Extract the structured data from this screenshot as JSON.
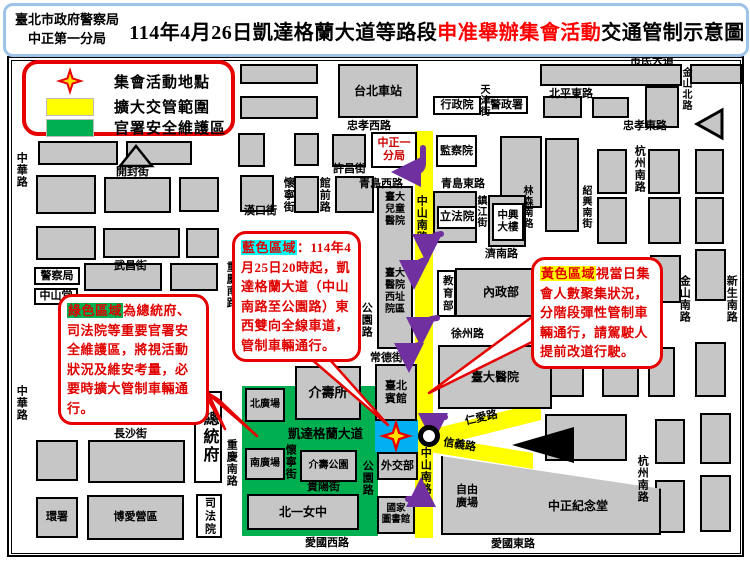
{
  "header": {
    "agency_line1": "臺北市政府警察局",
    "agency_line2": "中正第一分局",
    "title_prefix": "114年4月26日凱達格蘭大道等路段",
    "title_highlight": "申准舉辦集會活動",
    "title_suffix": "交通管制示意圖"
  },
  "legend": {
    "items": [
      {
        "symbol": "star-icon",
        "label": "集會活動地點"
      },
      {
        "symbol": "yellow-swatch",
        "label": "擴大交管範圍",
        "color": "#FFFF00"
      },
      {
        "symbol": "green-swatch",
        "label": "官署安全維護區",
        "color": "#00B050"
      }
    ]
  },
  "callouts": {
    "blue": {
      "highlight": "藍色區域",
      "text": "：114年4月25日20時起，凱達格蘭大道（中山南路至公園路）東西雙向全線車道，管制車輛通行。"
    },
    "green": {
      "highlight": "綠色區域",
      "text": "為總統府、司法院等重要官署安全維護區，將視活動狀況及維安考量，必要時擴大管制車輛通行。"
    },
    "yellow": {
      "highlight": "黃色區域",
      "text": "視當日集會人數聚集狀況，分階段彈性管制車輛通行，請駕駛人提前改道行駛。"
    }
  },
  "colors": {
    "zone_yellow": "#ffff00",
    "zone_green": "#00b050",
    "zone_blue": "#00b0f0",
    "callout_red": "#e60000",
    "purple_arrow": "#7030a0",
    "title_border_blue": "#9dc3e6",
    "block_gray": "#c6c6c6"
  },
  "map": {
    "zones": [
      {
        "id": "road-zhongshan-south-yellow",
        "x": 415,
        "y": 131,
        "w": 18,
        "h": 407,
        "color": "#ffff00"
      },
      {
        "id": "security-zone-green",
        "x": 242,
        "y": 386,
        "w": 136,
        "h": 150,
        "color": "#00b050"
      },
      {
        "id": "kaidagelan-east-blue",
        "x": 375,
        "y": 420,
        "w": 43,
        "h": 32,
        "color": "#00b0f0"
      }
    ],
    "blocks": [
      [
        36,
        64,
        64,
        20
      ],
      [
        36,
        92,
        64,
        23
      ],
      [
        240,
        64,
        78,
        20
      ],
      [
        240,
        96,
        78,
        23
      ],
      [
        540,
        64,
        142,
        22
      ],
      [
        690,
        64,
        52,
        20
      ],
      [
        543,
        96,
        39,
        22
      ],
      [
        592,
        97,
        37,
        21
      ],
      [
        645,
        86,
        34,
        42
      ],
      [
        238,
        133,
        27,
        34
      ],
      [
        294,
        133,
        25,
        33
      ],
      [
        332,
        134,
        34,
        33
      ],
      [
        38,
        141,
        80,
        24
      ],
      [
        126,
        141,
        66,
        24
      ],
      [
        36,
        175,
        60,
        39
      ],
      [
        104,
        177,
        67,
        36
      ],
      [
        179,
        177,
        40,
        35
      ],
      [
        240,
        175,
        34,
        37
      ],
      [
        294,
        176,
        25,
        37
      ],
      [
        335,
        176,
        39,
        37
      ],
      [
        36,
        226,
        60,
        34
      ],
      [
        103,
        228,
        77,
        30
      ],
      [
        186,
        228,
        33,
        30
      ],
      [
        84,
        263,
        78,
        28
      ],
      [
        170,
        263,
        48,
        28
      ],
      [
        500,
        136,
        42,
        72
      ],
      [
        545,
        138,
        34,
        94
      ],
      [
        597,
        149,
        30,
        45
      ],
      [
        597,
        197,
        30,
        47
      ],
      [
        648,
        149,
        32,
        45
      ],
      [
        648,
        197,
        33,
        47
      ],
      [
        695,
        149,
        29,
        45
      ],
      [
        695,
        197,
        29,
        47
      ],
      [
        550,
        265,
        42,
        42
      ],
      [
        600,
        259,
        43,
        44
      ],
      [
        650,
        255,
        31,
        48
      ],
      [
        695,
        249,
        31,
        52
      ],
      [
        547,
        355,
        37,
        42
      ],
      [
        602,
        352,
        37,
        45
      ],
      [
        648,
        347,
        27,
        50
      ],
      [
        695,
        342,
        31,
        55
      ],
      [
        545,
        414,
        82,
        47
      ],
      [
        655,
        419,
        30,
        45
      ],
      [
        700,
        413,
        31,
        51
      ],
      [
        655,
        480,
        30,
        53
      ],
      [
        700,
        475,
        31,
        57
      ],
      [
        36,
        440,
        42,
        41
      ],
      [
        88,
        440,
        97,
        43
      ],
      [
        433,
        191,
        44,
        52
      ],
      [
        488,
        195,
        38,
        52
      ],
      [
        377,
        186,
        36,
        163
      ],
      [
        441,
        451,
        220,
        84,
        "polygon(0 6%,100% 45%,100% 100%,0 100%)"
      ]
    ],
    "boxes": [
      {
        "t": "台北車站",
        "x": 338,
        "y": 64,
        "w": 80,
        "h": 54,
        "cls": "gb",
        "fs": 12,
        "name": "taipei-main-station"
      },
      {
        "t": "介壽所",
        "x": 295,
        "y": 366,
        "w": 66,
        "h": 54,
        "cls": "gb",
        "fs": 13,
        "name": "jieshou-police-post"
      },
      {
        "t": "北廣場",
        "x": 245,
        "y": 388,
        "w": 40,
        "h": 34,
        "cls": "gb",
        "fs": 10,
        "name": "north-plaza"
      },
      {
        "t": "南廣場",
        "x": 245,
        "y": 448,
        "w": 40,
        "h": 32,
        "cls": "gb",
        "fs": 10,
        "name": "south-plaza"
      },
      {
        "t": "介壽公園",
        "x": 300,
        "y": 450,
        "w": 57,
        "h": 32,
        "cls": "gb",
        "fs": 10,
        "name": "jieshou-park"
      },
      {
        "t": "北一女中",
        "x": 247,
        "y": 494,
        "w": 112,
        "h": 36,
        "cls": "gb",
        "fs": 12,
        "name": "taipei-first-girls-hs"
      },
      {
        "t": "臺北\n賓館",
        "x": 375,
        "y": 364,
        "w": 42,
        "h": 57,
        "cls": "gb",
        "fs": 11,
        "name": "taipei-guest-house"
      },
      {
        "t": "外交部",
        "x": 377,
        "y": 452,
        "w": 41,
        "h": 28,
        "cls": "gb",
        "fs": 11,
        "name": "ministry-foreign-affairs"
      },
      {
        "t": "國家\n圖書館",
        "x": 377,
        "y": 496,
        "w": 38,
        "h": 38,
        "cls": "gb",
        "fs": 9.5,
        "name": "national-library"
      },
      {
        "t": "內政部",
        "x": 455,
        "y": 268,
        "w": 92,
        "h": 49,
        "cls": "gb",
        "fs": 12,
        "name": "ministry-interior"
      },
      {
        "t": "臺大醫院",
        "x": 438,
        "y": 345,
        "w": 114,
        "h": 64,
        "cls": "gb",
        "fs": 12,
        "name": "ntu-hospital"
      },
      {
        "t": "環署",
        "x": 36,
        "y": 497,
        "w": 42,
        "h": 41,
        "cls": "gb",
        "fs": 11,
        "name": "epa"
      },
      {
        "t": "博愛營區",
        "x": 87,
        "y": 495,
        "w": 97,
        "h": 45,
        "cls": "gb",
        "fs": 11,
        "name": "boai-camp"
      },
      {
        "t": "行政院",
        "x": 433,
        "y": 96,
        "w": 48,
        "h": 19,
        "cls": "wb",
        "fs": 11,
        "name": "executive-yuan"
      },
      {
        "t": "警政署",
        "x": 485,
        "y": 96,
        "w": 43,
        "h": 18,
        "cls": "wb",
        "fs": 11,
        "name": "national-police-agency"
      },
      {
        "t": "監察院",
        "x": 436,
        "y": 135,
        "w": 41,
        "h": 32,
        "cls": "wb",
        "fs": 11,
        "name": "control-yuan"
      },
      {
        "t": "中正一\n分局",
        "x": 371,
        "y": 132,
        "w": 46,
        "h": 36,
        "cls": "wb red",
        "fs": 11,
        "name": "zhongzheng-first-precinct"
      },
      {
        "t": "立法院",
        "x": 437,
        "y": 206,
        "w": 40,
        "h": 23,
        "cls": "wb",
        "fs": 11.5,
        "name": "legislative-yuan"
      },
      {
        "t": "中興\n大樓",
        "x": 492,
        "y": 203,
        "w": 32,
        "h": 38,
        "cls": "wb",
        "fs": 10.5,
        "name": "zhongxing-building"
      },
      {
        "t": "教育部",
        "x": 437,
        "y": 270,
        "w": 19,
        "h": 47,
        "cls": "wb vert",
        "fs": 10.5,
        "name": "ministry-education"
      },
      {
        "t": "警察局",
        "x": 34,
        "y": 267,
        "w": 46,
        "h": 18,
        "cls": "wb",
        "fs": 11,
        "name": "police-department"
      },
      {
        "t": "中山堂",
        "x": 34,
        "y": 288,
        "w": 44,
        "h": 17,
        "cls": "wb",
        "fs": 11,
        "name": "zhongshan-hall"
      },
      {
        "t": "總統府",
        "x": 194,
        "y": 391,
        "w": 28,
        "h": 92,
        "cls": "wb vert",
        "fs": 16,
        "name": "presidential-office"
      },
      {
        "t": "司法院",
        "x": 196,
        "y": 494,
        "w": 26,
        "h": 44,
        "cls": "wb vert",
        "fs": 11,
        "name": "judicial-yuan"
      }
    ],
    "labels": [
      {
        "t": "市民大道",
        "x": 630,
        "y": 55,
        "cls": "r"
      },
      {
        "t": "北平東路",
        "x": 549,
        "y": 88,
        "cls": "r"
      },
      {
        "t": "忠孝西路",
        "x": 347,
        "y": 120,
        "cls": "r"
      },
      {
        "t": "忠孝東路",
        "x": 623,
        "y": 120,
        "cls": "r"
      },
      {
        "t": "許昌街",
        "x": 333,
        "y": 163,
        "cls": "r"
      },
      {
        "t": "青島西路",
        "x": 359,
        "y": 178,
        "cls": "r"
      },
      {
        "t": "青島東路",
        "x": 441,
        "y": 178,
        "cls": "r"
      },
      {
        "t": "開封街",
        "x": 116,
        "y": 166,
        "cls": "r"
      },
      {
        "t": "漢口街",
        "x": 244,
        "y": 205,
        "cls": "r"
      },
      {
        "t": "武昌街",
        "x": 114,
        "y": 260,
        "cls": "r"
      },
      {
        "t": "濟南路",
        "x": 485,
        "y": 248,
        "cls": "r"
      },
      {
        "t": "徐州路",
        "x": 451,
        "y": 328,
        "cls": "r"
      },
      {
        "t": "常德街",
        "x": 370,
        "y": 352,
        "cls": "r"
      },
      {
        "t": "長沙街",
        "x": 114,
        "y": 428,
        "cls": "r"
      },
      {
        "t": "貴陽街",
        "x": 307,
        "y": 481,
        "cls": "r"
      },
      {
        "t": "愛國西路",
        "x": 305,
        "y": 537,
        "cls": "r"
      },
      {
        "t": "愛國東路",
        "x": 491,
        "y": 538,
        "cls": "r"
      },
      {
        "t": "仁愛路",
        "x": 465,
        "y": 412,
        "cls": "r",
        "rot": -13
      },
      {
        "t": "信義路",
        "x": 443,
        "y": 439,
        "cls": "r",
        "rot": 9
      },
      {
        "t": "凱達格蘭大道",
        "x": 288,
        "y": 427,
        "cls": "r",
        "fs": 12.5
      },
      {
        "t": "中華路",
        "x": 14,
        "y": 152,
        "cls": "v"
      },
      {
        "t": "中華路",
        "x": 14,
        "y": 385,
        "cls": "v"
      },
      {
        "t": "重慶南路",
        "x": 224,
        "y": 261,
        "cls": "v"
      },
      {
        "t": "重慶南路",
        "x": 224,
        "y": 439,
        "cls": "v"
      },
      {
        "t": "懷寧街",
        "x": 281,
        "y": 177,
        "cls": "v"
      },
      {
        "t": "館前路",
        "x": 317,
        "y": 177,
        "cls": "v"
      },
      {
        "t": "懷寧街",
        "x": 283,
        "y": 444,
        "cls": "v"
      },
      {
        "t": "公園路",
        "x": 359,
        "y": 302,
        "cls": "v"
      },
      {
        "t": "公園路",
        "x": 360,
        "y": 460,
        "cls": "v"
      },
      {
        "t": "天津街",
        "x": 477,
        "y": 84,
        "cls": "v",
        "fs": 10
      },
      {
        "t": "金山北路",
        "x": 679,
        "y": 67,
        "cls": "v",
        "fs": 10
      },
      {
        "t": "杭州南路",
        "x": 632,
        "y": 145,
        "cls": "v"
      },
      {
        "t": "杭州南路",
        "x": 635,
        "y": 455,
        "cls": "v"
      },
      {
        "t": "林森南路",
        "x": 520,
        "y": 185,
        "cls": "v",
        "fs": 10
      },
      {
        "t": "紹興南街",
        "x": 579,
        "y": 185,
        "cls": "v",
        "fs": 10
      },
      {
        "t": "鎮江街",
        "x": 474,
        "y": 195,
        "cls": "v",
        "fs": 10
      },
      {
        "t": "中山南路",
        "x": 414,
        "y": 195,
        "cls": "v"
      },
      {
        "t": "中山南路",
        "x": 418,
        "y": 447,
        "cls": "v"
      },
      {
        "t": "金山南路",
        "x": 677,
        "y": 275,
        "cls": "v"
      },
      {
        "t": "新生南路",
        "x": 724,
        "y": 275,
        "cls": "v"
      },
      {
        "t": "臺大\n兒童\n醫院",
        "x": 379,
        "y": 192,
        "cls": "bt",
        "w": 32,
        "fs": 10
      },
      {
        "t": "臺大\n醫院\n西址\n院區",
        "x": 379,
        "y": 268,
        "cls": "bt",
        "w": 32,
        "fs": 10
      },
      {
        "t": "自由\n廣場",
        "x": 450,
        "y": 484,
        "cls": "bt",
        "w": 34,
        "fs": 11
      },
      {
        "t": "中正紀念堂",
        "x": 548,
        "y": 499,
        "cls": "bt",
        "fs": 12
      }
    ]
  }
}
